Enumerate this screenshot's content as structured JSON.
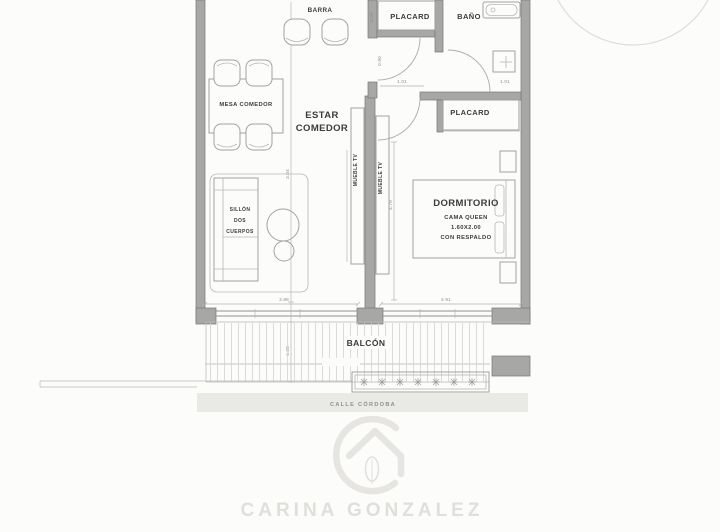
{
  "rooms": {
    "barra": "BARRA",
    "mesa_comedor": "MESA COMEDOR",
    "estar": [
      "ESTAR",
      "COMEDOR"
    ],
    "sillon": [
      "SILLÓN",
      "DOS",
      "CUERPOS"
    ],
    "placard_top": "PLACARD",
    "bano": "BAÑO",
    "placard_hall": "PLACARD",
    "dormitorio": "DORMITORIO",
    "bed": [
      "CAMA QUEEN",
      "1.60X2.00",
      "CON RESPALDO"
    ],
    "mueble_tv": "MUEBLE TV",
    "balcon": "BALCÓN",
    "street": "CALLE CÓRDOBA"
  },
  "dimensions": {
    "estar_width": "3.88",
    "dorm_width": "2.91",
    "balcon_width": "9.47",
    "balcon_depth": "1.28",
    "estar_length": "3.04",
    "dorm_length": "4.79",
    "door_hall": "1.01",
    "door_bano": "1.01",
    "placard_depth": "0.60",
    "hall_width": "0.90"
  },
  "watermark": {
    "agent_name": "CARINA GONZALEZ"
  },
  "colors": {
    "wall": "#a7a7a5",
    "wall_edge": "#757573",
    "furniture_line": "#a2a2a0",
    "label_text": "#3b3b39",
    "dimension_text": "#8c8c8a",
    "street_band": "#e9e9e6",
    "street_text": "#8f8f8b",
    "watermark": "#e3e1dd",
    "background": "#fcfcfb"
  }
}
